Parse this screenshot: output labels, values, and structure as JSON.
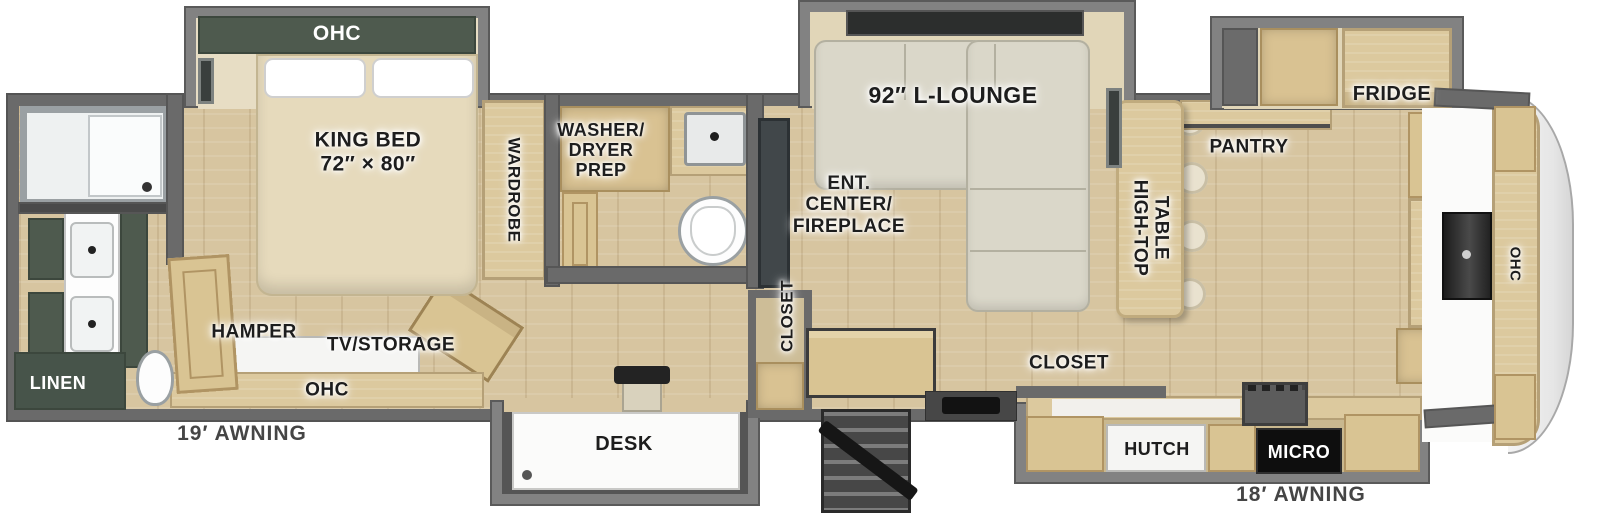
{
  "floorplan": {
    "type": "RV fifth-wheel floor plan",
    "colors": {
      "wall": "#6a6a6a",
      "slide_wall": "#828282",
      "floor_wood": "#d7c5a0",
      "cabinet_wood": "#dcc99e",
      "cabinet_green": "#4e5a4e",
      "counter_dark": "#474747",
      "sofa": "#dad7c9",
      "front_cap": "#ededed",
      "micro_black": "#0e0e0e",
      "label_text": "#1d1d1d"
    },
    "labels": {
      "bed_slide_ohc": "OHC",
      "king_bed_line1": "KING BED",
      "king_bed_line2": "72″ × 80″",
      "wardrobe": "WARDROBE",
      "washer_line1": "WASHER/",
      "washer_line2": "DRYER",
      "washer_line3": "PREP",
      "l_lounge": "92″ L-LOUNGE",
      "ent_line1": "ENT.",
      "ent_line2": "CENTER/",
      "ent_line3": "FIREPLACE",
      "closet_mid_vertical": "CLOSET",
      "hamper": "HAMPER",
      "tv_storage": "TV/STORAGE",
      "bedroom_ohc": "OHC",
      "linen": "LINEN",
      "awning_rear": "19′ AWNING",
      "desk": "DESK",
      "closet_front": "CLOSET",
      "high_top_line1": "HIGH-TOP",
      "high_top_line2": "TABLE",
      "pantry": "PANTRY",
      "fridge": "FRIDGE",
      "hutch": "HUTCH",
      "micro": "MICRO",
      "awning_front": "18′ AWNING",
      "front_cap_ohc": "OHC"
    }
  }
}
